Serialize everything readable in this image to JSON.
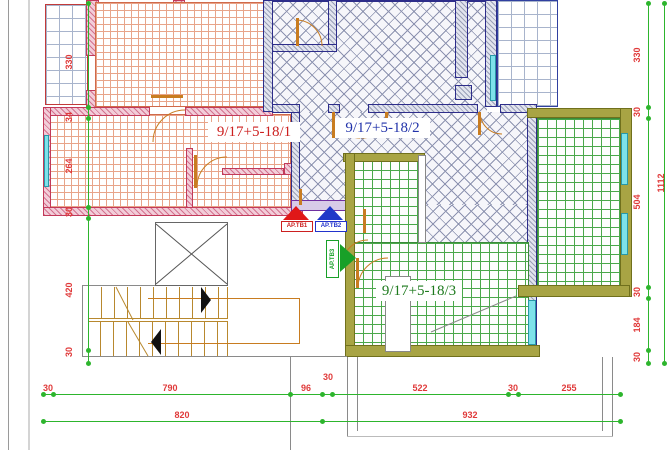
{
  "apartments": [
    {
      "id": "apartment-1",
      "label": "9/17+5-18/1",
      "color": "#cc2020",
      "fill": "red-grid"
    },
    {
      "id": "apartment-2",
      "label": "9/17+5-18/2",
      "color": "#2233aa",
      "fill": "blue-crosshatch"
    },
    {
      "id": "apartment-3",
      "label": "9/17+5-18/3",
      "color": "#1e7a1e",
      "fill": "green-grid"
    }
  ],
  "markers": [
    {
      "id": "marker-1",
      "label": "AP.TB1",
      "color": "#cc2020",
      "arrow": "up-red"
    },
    {
      "id": "marker-2",
      "label": "AP.TB2",
      "color": "#2233cc",
      "arrow": "up-blue"
    },
    {
      "id": "marker-3",
      "label": "AP.TB3",
      "color": "#18a028",
      "arrow": "right-green"
    }
  ],
  "dims": {
    "left": [
      "330",
      "34",
      "264",
      "30",
      "420",
      "30"
    ],
    "right": [
      "330",
      "30",
      "504",
      "30",
      "184",
      "30"
    ],
    "right_total": "1112",
    "bottom_row1": [
      "30",
      "790",
      "96",
      "30",
      "522",
      "30",
      "255"
    ],
    "bottom_row2": [
      "820",
      "932"
    ]
  },
  "colors": {
    "dimension_line": "#2db52d",
    "dimension_text": "#e03a3a",
    "wall_pink": "#d4728f",
    "wall_gray_blue": "#2d2d8a",
    "wall_olive": "#a8a444",
    "window_cyan": "#7ee2ea",
    "door_orange": "#c87c20",
    "stair_tan": "#b8882e"
  }
}
